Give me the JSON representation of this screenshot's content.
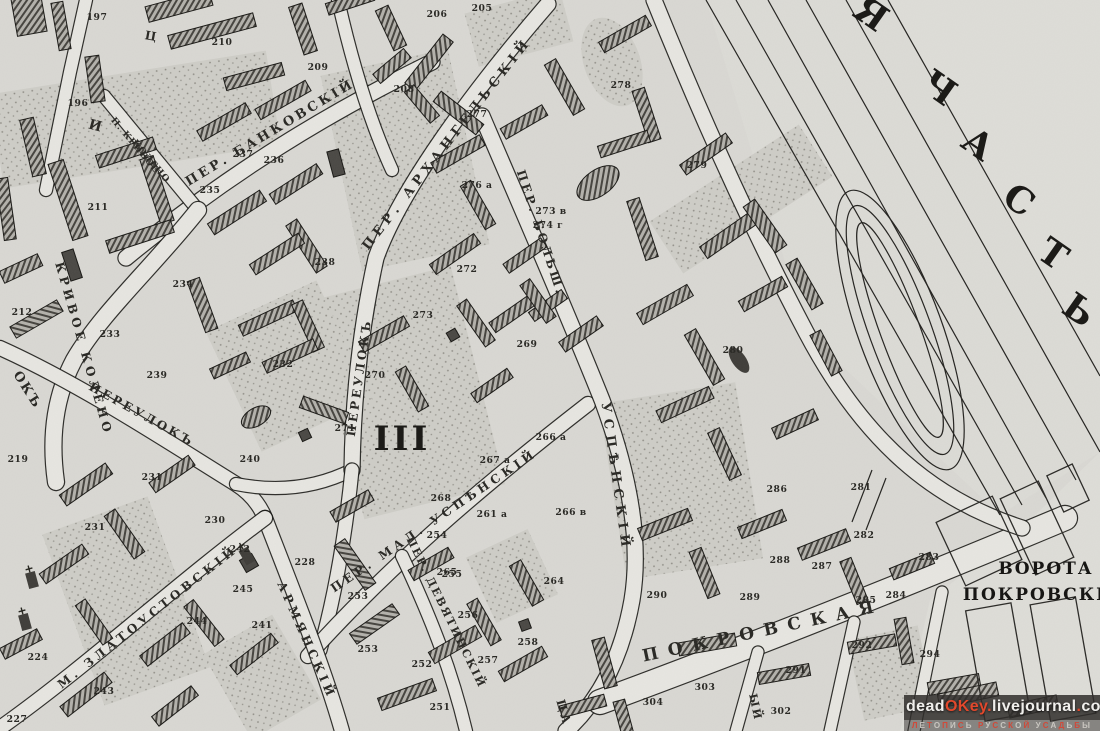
{
  "map": {
    "plot_roman_numeral": {
      "t": "III",
      "x": 402,
      "y": 450,
      "s": 34
    },
    "district_letters": {
      "rot": 35,
      "s": 36,
      "letters": [
        {
          "t": "Я",
          "x": 864,
          "y": 24
        },
        {
          "t": "Ч",
          "x": 932,
          "y": 98
        },
        {
          "t": "А",
          "x": 971,
          "y": 154
        },
        {
          "t": "С",
          "x": 1012,
          "y": 210
        },
        {
          "t": "Т",
          "x": 1046,
          "y": 264
        },
        {
          "t": "Ь",
          "x": 1072,
          "y": 320
        }
      ]
    },
    "landmark_labels": [
      {
        "t": "ВОРОТА",
        "x": 1046,
        "y": 574,
        "s": 17
      },
      {
        "t": "ПОКРОВСКІЯ",
        "x": 1043,
        "y": 600,
        "s": 17
      }
    ],
    "street_labels": [
      {
        "t": "ПЕР. БАНКОВСКІЙ",
        "x": 272,
        "y": 136,
        "r": -31,
        "s": 13,
        "ls": 3
      },
      {
        "t": "П. КРИВОЕ",
        "x": 133,
        "y": 147,
        "r": 50,
        "s": 9,
        "ls": 1
      },
      {
        "t": "КОЛЕНО",
        "x": 149,
        "y": 163,
        "r": 50,
        "s": 9,
        "ls": 1
      },
      {
        "t": "КРИВОЕ КОЛЕНО",
        "x": 80,
        "y": 350,
        "r": 74,
        "s": 12,
        "ls": 4
      },
      {
        "t": "ПЕРЕУЛОКЪ",
        "x": 140,
        "y": 418,
        "r": 29,
        "s": 12,
        "ls": 3
      },
      {
        "t": "ОКЪ",
        "x": 24,
        "y": 392,
        "r": 58,
        "s": 13,
        "ls": 2
      },
      {
        "t": "И",
        "x": 94,
        "y": 130,
        "r": 15,
        "s": 14,
        "ls": 0
      },
      {
        "t": "Ц",
        "x": 150,
        "y": 40,
        "r": 10,
        "s": 12,
        "ls": 0
      },
      {
        "t": "ПЕР. АРХАНГЕЛЬСКІЙ",
        "x": 450,
        "y": 146,
        "r": -52,
        "s": 13,
        "ls": 5
      },
      {
        "t": "ПЕРЕУЛОКЪ",
        "x": 363,
        "y": 378,
        "r": -82,
        "s": 12,
        "ls": 3
      },
      {
        "t": "ПЕР. БОЛЬШ.",
        "x": 537,
        "y": 234,
        "r": 72,
        "s": 12,
        "ls": 3
      },
      {
        "t": "УСПѢНСКІЙ",
        "x": 612,
        "y": 478,
        "r": 82,
        "s": 13,
        "ls": 6
      },
      {
        "t": "ПЕР. МАЛ. УСПѢНСКІЙ",
        "x": 436,
        "y": 524,
        "r": -34,
        "s": 12,
        "ls": 4
      },
      {
        "t": "ПЕР. ДЕВЯТИНСКІЙ",
        "x": 443,
        "y": 614,
        "r": 64,
        "s": 11,
        "ls": 2
      },
      {
        "t": "АРМЯНСКІЙ",
        "x": 303,
        "y": 642,
        "r": 66,
        "s": 12,
        "ls": 4
      },
      {
        "t": "М. ЗЛАТОУСТОВСКІЙ",
        "x": 150,
        "y": 620,
        "r": -38,
        "s": 12,
        "ls": 4
      },
      {
        "t": "ПОКРОВСКАЯ",
        "x": 764,
        "y": 636,
        "r": -12,
        "s": 17,
        "ls": 10
      },
      {
        "t": "ЫЙ",
        "x": 752,
        "y": 708,
        "r": 78,
        "s": 11,
        "ls": 2
      },
      {
        "t": "ЦА",
        "x": 560,
        "y": 714,
        "r": 74,
        "s": 12,
        "ls": 3
      }
    ],
    "building_numbers": [
      [
        "197",
        97,
        20
      ],
      [
        "210",
        222,
        45
      ],
      [
        "196",
        78,
        106
      ],
      [
        "206",
        437,
        17
      ],
      [
        "205",
        482,
        11
      ],
      [
        "209",
        318,
        70
      ],
      [
        "208",
        404,
        92
      ],
      [
        "236",
        274,
        163
      ],
      [
        "235",
        210,
        193
      ],
      [
        "237",
        243,
        157
      ],
      [
        "277",
        477,
        117
      ],
      [
        "278",
        621,
        88
      ],
      [
        "279",
        697,
        168
      ],
      [
        "273 в",
        551,
        214
      ],
      [
        "274 г",
        548,
        228
      ],
      [
        "276 а",
        477,
        188
      ],
      [
        "272",
        467,
        272
      ],
      [
        "273",
        423,
        318
      ],
      [
        "211",
        98,
        210
      ],
      [
        "234",
        183,
        287
      ],
      [
        "238",
        325,
        265
      ],
      [
        "212",
        22,
        315
      ],
      [
        "233",
        110,
        337
      ],
      [
        "232",
        283,
        367
      ],
      [
        "239",
        157,
        378
      ],
      [
        "240",
        250,
        462
      ],
      [
        "270",
        375,
        378
      ],
      [
        "271",
        345,
        431
      ],
      [
        "269",
        527,
        347
      ],
      [
        "280",
        733,
        353
      ],
      [
        "231",
        152,
        480
      ],
      [
        "230",
        215,
        523
      ],
      [
        "231",
        95,
        530
      ],
      [
        "219",
        18,
        462
      ],
      [
        "224",
        38,
        660
      ],
      [
        "227",
        17,
        722
      ],
      [
        "244",
        197,
        624
      ],
      [
        "243",
        104,
        694
      ],
      [
        "245",
        243,
        592
      ],
      [
        "241",
        262,
        628
      ],
      [
        "242",
        240,
        552
      ],
      [
        "228",
        305,
        565
      ],
      [
        "254",
        437,
        538
      ],
      [
        "253",
        358,
        599
      ],
      [
        "253",
        368,
        652
      ],
      [
        "255",
        452,
        577
      ],
      [
        "252",
        422,
        667
      ],
      [
        "256",
        468,
        618
      ],
      [
        "257",
        488,
        663
      ],
      [
        "251",
        440,
        710
      ],
      [
        "258",
        528,
        645
      ],
      [
        "261 а",
        492,
        517
      ],
      [
        "266 а",
        551,
        440
      ],
      [
        "267 а",
        495,
        463
      ],
      [
        "266 в",
        571,
        515
      ],
      [
        "268",
        441,
        501
      ],
      [
        "264",
        554,
        584
      ],
      [
        "265",
        447,
        575
      ],
      [
        "290",
        657,
        598
      ],
      [
        "289",
        750,
        600
      ],
      [
        "288",
        780,
        563
      ],
      [
        "287",
        822,
        569
      ],
      [
        "291",
        796,
        673
      ],
      [
        "292",
        862,
        648
      ],
      [
        "303",
        705,
        690
      ],
      [
        "304",
        653,
        705
      ],
      [
        "302",
        781,
        714
      ],
      [
        "286",
        777,
        492
      ],
      [
        "281",
        861,
        490
      ],
      [
        "282",
        864,
        538
      ],
      [
        "283",
        929,
        560
      ],
      [
        "284",
        896,
        598
      ],
      [
        "285",
        866,
        603
      ],
      [
        "294",
        930,
        657
      ]
    ]
  },
  "watermark": {
    "line1_parts": [
      {
        "t": "dead",
        "c": "#f0efec"
      },
      {
        "t": "OKey",
        "c": "#e2482c"
      },
      {
        "t": ".",
        "c": "#e2482c"
      },
      {
        "t": "livejournal",
        "c": "#f0efec"
      },
      {
        "t": ".",
        "c": "#e2482c"
      },
      {
        "t": "com",
        "c": "#f0efec"
      }
    ],
    "line2": "ЛЕТОПИСЬ РУССКОЙ УСАДЬБЫ",
    "line2_colors": [
      "#cf4a3a",
      "#c9c6c0"
    ]
  }
}
